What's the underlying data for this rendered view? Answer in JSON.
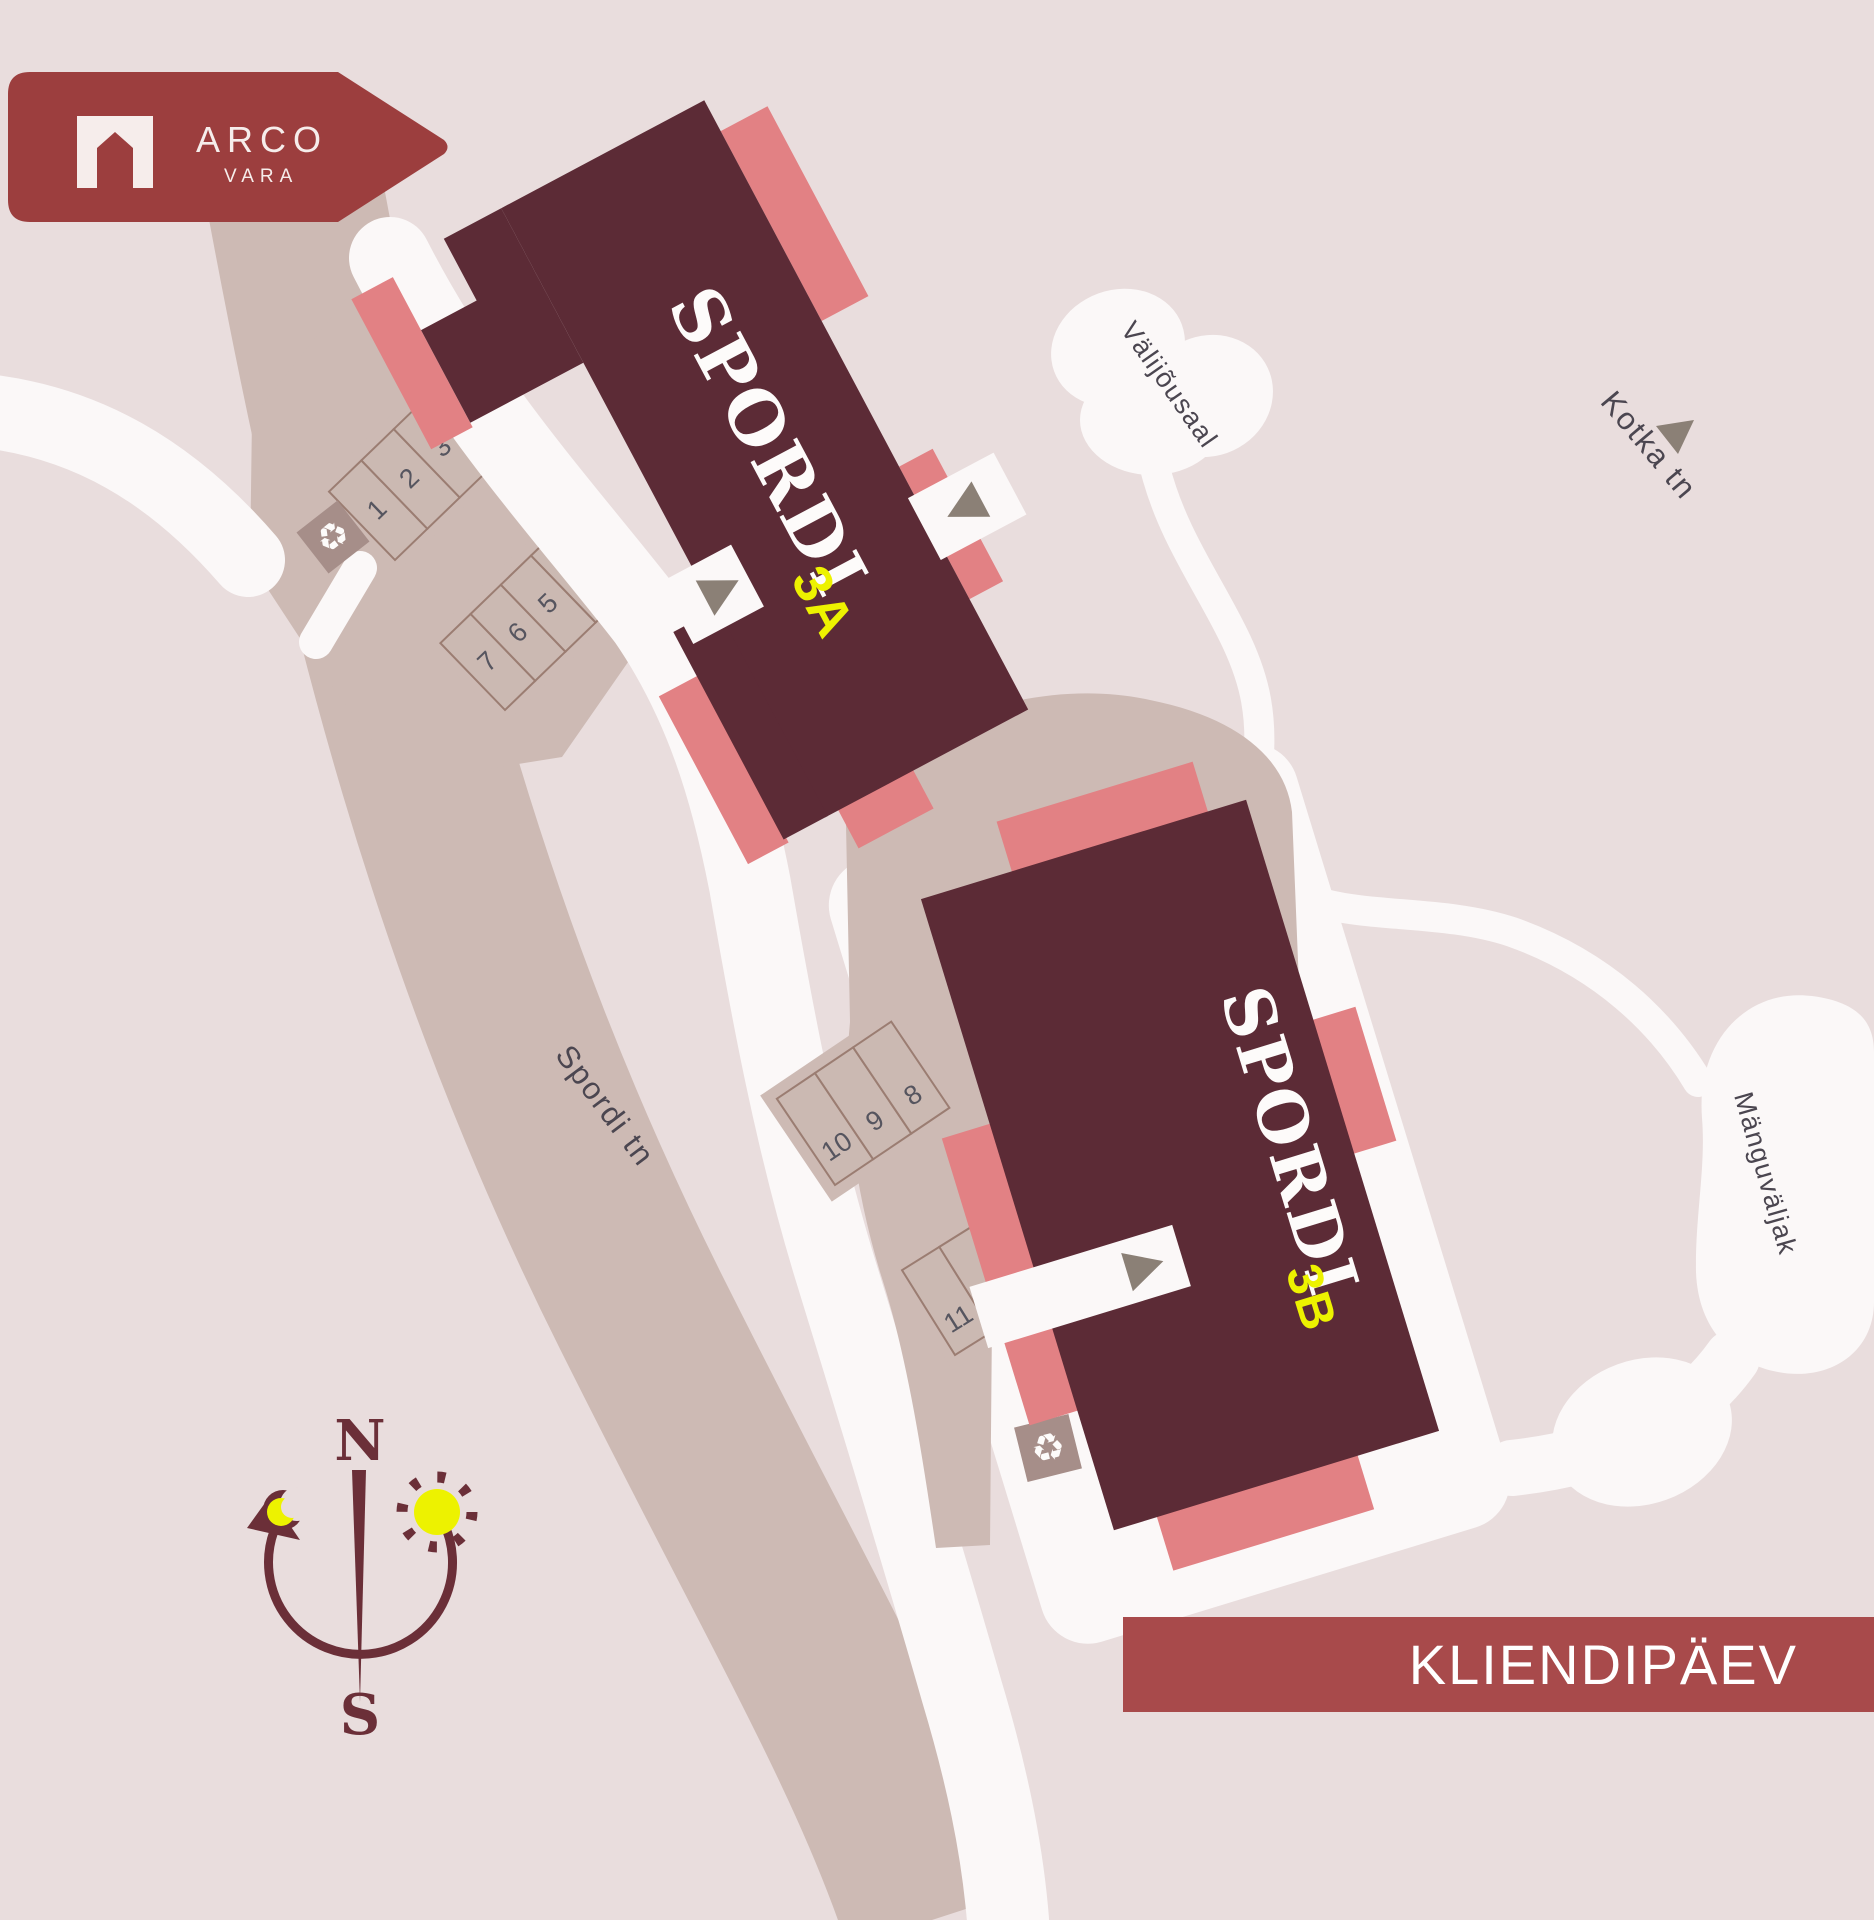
{
  "badge": {
    "brand": "ARCO",
    "sub": "VARA"
  },
  "banner": {
    "label": "KLIENDIPÄEV"
  },
  "buildings": {
    "a": {
      "name": "SPORDI",
      "unit": "3A"
    },
    "b": {
      "name": "SPORDI",
      "unit": "3B"
    }
  },
  "streets": {
    "spordi": "Spordi tn",
    "kotka": "Kotka tn"
  },
  "areas": {
    "outdoor_gym": "Välijõusaal",
    "playground": "Mänguväljak"
  },
  "compass": {
    "north": "N",
    "south": "S"
  },
  "parking": {
    "spots": [
      "1",
      "2",
      "3",
      "4",
      "5",
      "6",
      "7",
      "8",
      "9",
      "10",
      "11",
      "12",
      "13",
      "14",
      "15"
    ]
  },
  "icons": {
    "recycle": "♻"
  },
  "colors": {
    "background": "#e9dddd",
    "road_white": "#fbf8f8",
    "street_taupe": "#cdbab4",
    "stall_border": "#9b7d72",
    "building_maroon": "#5c2b36",
    "terrace_salmon": "#e28184",
    "badge_red": "#9c3e3e",
    "banner_red": "#a84a4b",
    "accent_yellow": "#edf200",
    "number_gray": "#56555f",
    "label_gray": "#4b4650",
    "arrow_gray": "#8b8076",
    "compass_maroon": "#6b2f38",
    "recycle_pad": "#a68e89"
  }
}
